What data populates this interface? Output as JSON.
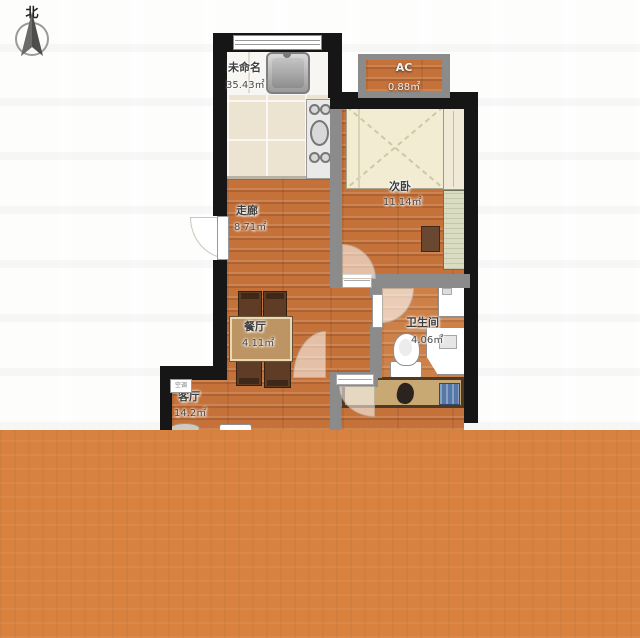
{
  "compass": {
    "north_label": "北"
  },
  "rooms": {
    "kitchen": {
      "name": "未命名",
      "area": "35.43㎡"
    },
    "ac": {
      "name": "AC",
      "area": "0.88㎡"
    },
    "bedroom": {
      "name": "次卧",
      "area": "11.14㎡"
    },
    "corridor": {
      "name": "走廊",
      "area": "8.71㎡"
    },
    "dining": {
      "name": "餐厅",
      "area": "4.11㎡"
    },
    "bathroom": {
      "name": "卫生间",
      "area": "4.06㎡"
    },
    "living": {
      "name": "客厅",
      "area": "14.2㎡"
    }
  },
  "annotations": {
    "ac_unit": "空调"
  },
  "colors": {
    "wall": "#161616",
    "wallgray": "#8B8B8B",
    "wood": "#C5713A",
    "tile": "#ECE3D1",
    "counter": "#F7F6F2",
    "overlay": "#D9823F",
    "bed": "#F1ECD2",
    "table": "#BD9564",
    "chair": "#5E3C26",
    "closet": "#C8A873"
  }
}
